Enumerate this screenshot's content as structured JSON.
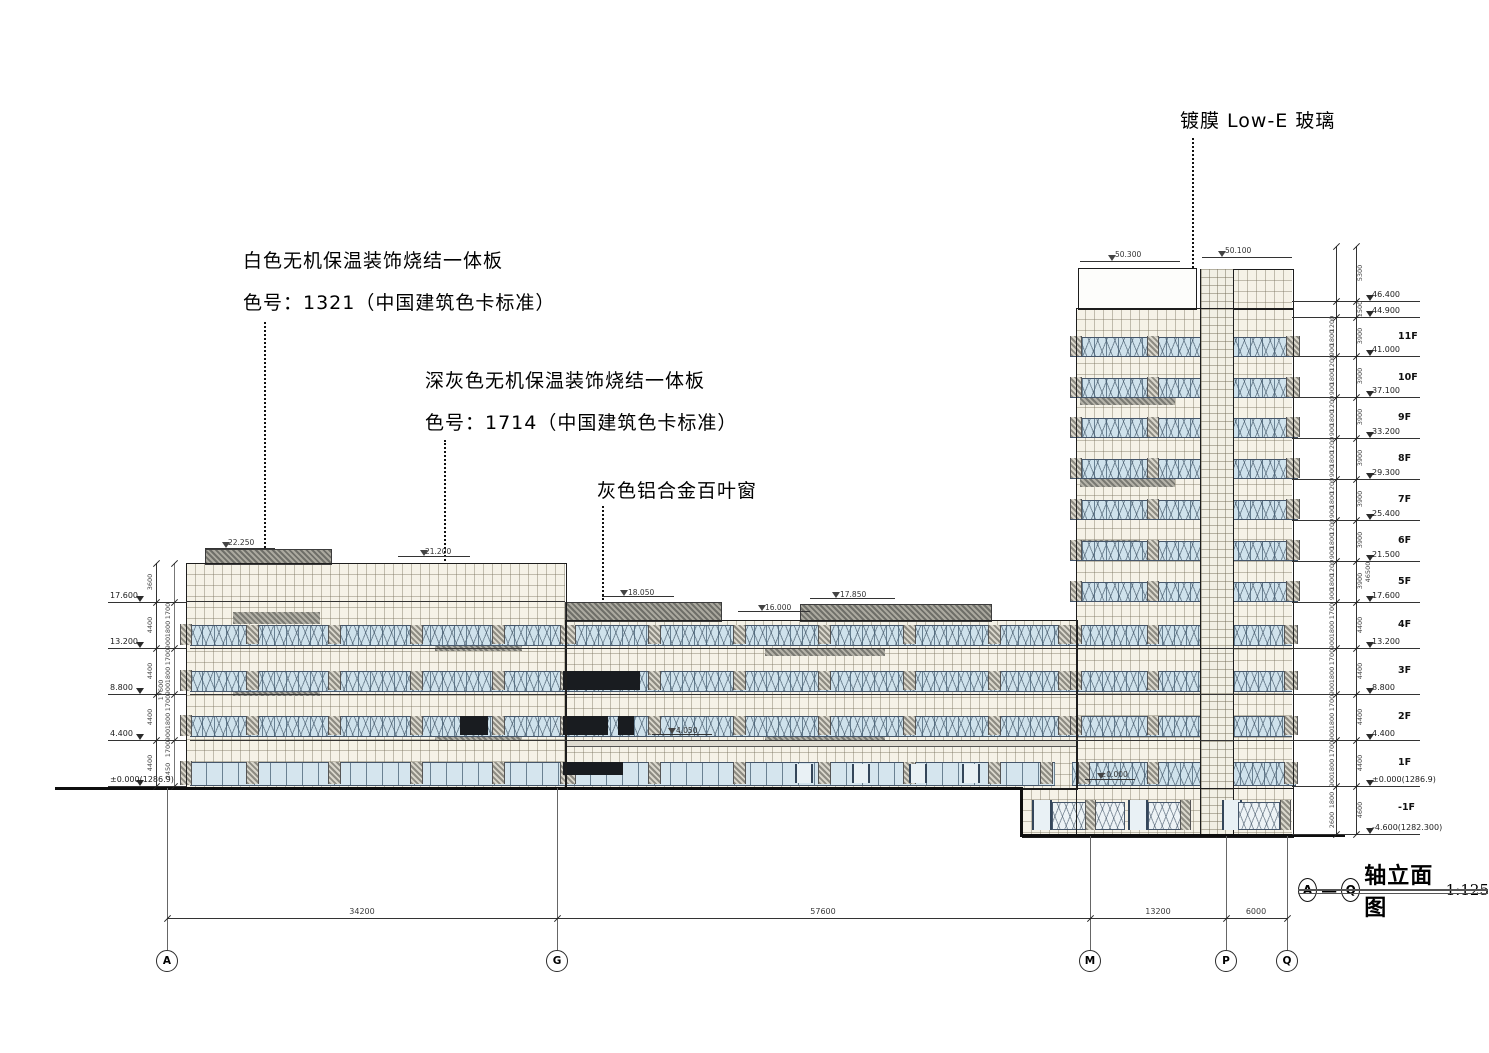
{
  "annotations": {
    "lowe_glass": {
      "text": "镀膜 Low-E 玻璃"
    },
    "white_panel": {
      "line1": "白色无机保温装饰烧结一体板",
      "line2": "色号：1321（中国建筑色卡标准）"
    },
    "dark_panel": {
      "line1": "深灰色无机保温装饰烧结一体板",
      "line2": "色号：1714（中国建筑色卡标准）"
    },
    "louver": {
      "text": "灰色铝合金百叶窗"
    }
  },
  "title_block": {
    "axis_start": "A",
    "axis_end": "Q",
    "separator": "—",
    "title": "轴立面图",
    "scale": "1:125"
  },
  "grid_axes": [
    "A",
    "G",
    "M",
    "P",
    "Q"
  ],
  "axis_span_dims": [
    "34200",
    "57600",
    "13200",
    "6000"
  ],
  "levels_left": [
    "17.600",
    "13.200",
    "8.800",
    "4.400",
    "±0.000(1286.9)"
  ],
  "levels_right": [
    "46.400",
    "44.900",
    "41.000",
    "37.100",
    "33.200",
    "29.300",
    "25.400",
    "21.500",
    "17.600",
    "13.200",
    "8.800",
    "4.400",
    "±0.000(1286.9)",
    "-4.600(1282.300)"
  ],
  "floor_labels": [
    "11F",
    "10F",
    "9F",
    "8F",
    "7F",
    "6F",
    "5F",
    "4F",
    "3F",
    "2F",
    "1F",
    "-1F"
  ],
  "roof_marks": [
    "22.250",
    "21.200",
    "18.050",
    "16.000",
    "17.850",
    "50.300",
    "50.100",
    "4.050",
    "±0.000"
  ],
  "dims_left": {
    "story": [
      "3600",
      "4400",
      "4400",
      "4400",
      "4400"
    ],
    "sub": [
      "1700",
      "1800",
      "900"
    ],
    "sub_ground": [
      "1700",
      "2450"
    ],
    "overall": "17600"
  },
  "dims_right": {
    "story": [
      "5300",
      "1500",
      "3900",
      "3900",
      "3900",
      "3900",
      "3900",
      "3900",
      "3900",
      "4400",
      "4400",
      "4400",
      "4400",
      "4600"
    ],
    "sub_upper": [
      "1200",
      "1800",
      "900"
    ],
    "sub_lower": [
      "1700",
      "1800",
      "900"
    ],
    "sub_basement": [
      "1800",
      "2600"
    ],
    "overall": "46500"
  },
  "colors": {
    "wall_tile": "#f5f2e7",
    "window_glass": "#cfe2ec",
    "dark_panel_hatch": "#6f6f69",
    "louver_dark": "#191c20"
  }
}
